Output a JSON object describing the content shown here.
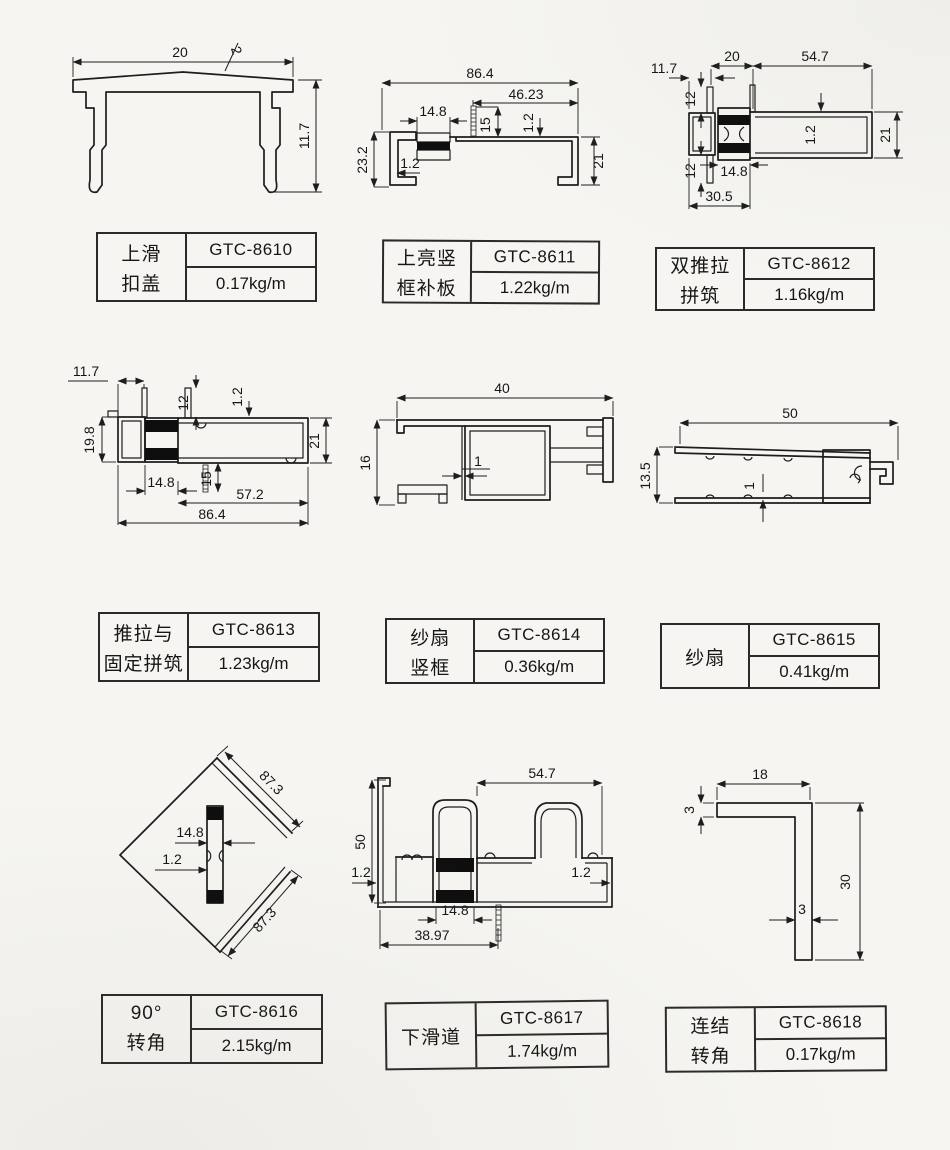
{
  "page": {
    "background": "#f6f5f1",
    "line_color": "#1d1d1d"
  },
  "cells": [
    {
      "name1": "上滑",
      "name2": "扣盖",
      "code": "GTC-8610",
      "weight": "0.17kg/m",
      "dims": [
        "20",
        "2",
        "11.7"
      ]
    },
    {
      "name1": "上亮竖",
      "name2": "框补板",
      "code": "GTC-8611",
      "weight": "1.22kg/m",
      "dims": [
        "86.4",
        "46.23",
        "14.8",
        "15",
        "1.2",
        "23.2",
        "1.2",
        "21"
      ]
    },
    {
      "name1": "双推拉",
      "name2": "拼筑",
      "code": "GTC-8612",
      "weight": "1.16kg/m",
      "dims": [
        "11.7",
        "20",
        "54.7",
        "12",
        "1.2",
        "21",
        "14.8",
        "12",
        "30.5"
      ]
    },
    {
      "name1": "推拉与",
      "name2": "固定拼筑",
      "code": "GTC-8613",
      "weight": "1.23kg/m",
      "dims": [
        "11.7",
        "12",
        "1.2",
        "19.8",
        "21",
        "14.8",
        "15",
        "57.2",
        "86.4"
      ]
    },
    {
      "name1": "纱扇",
      "name2": "竖框",
      "code": "GTC-8614",
      "weight": "0.36kg/m",
      "dims": [
        "40",
        "16",
        "1"
      ]
    },
    {
      "name1": "纱扇",
      "name2": "",
      "code": "GTC-8615",
      "weight": "0.41kg/m",
      "dims": [
        "50",
        "13.5",
        "1"
      ]
    },
    {
      "name1": "90°",
      "name2": "转角",
      "code": "GTC-8616",
      "weight": "2.15kg/m",
      "dims": [
        "87.3",
        "14.8",
        "1.2",
        "87.3"
      ]
    },
    {
      "name1": "下滑道",
      "name2": "",
      "code": "GTC-8617",
      "weight": "1.74kg/m",
      "dims": [
        "54.7",
        "50",
        "1.2",
        "1.2",
        "14.8",
        "38.97"
      ]
    },
    {
      "name1": "连结",
      "name2": "转角",
      "code": "GTC-8618",
      "weight": "0.17kg/m",
      "dims": [
        "18",
        "3",
        "30",
        "3"
      ]
    }
  ]
}
